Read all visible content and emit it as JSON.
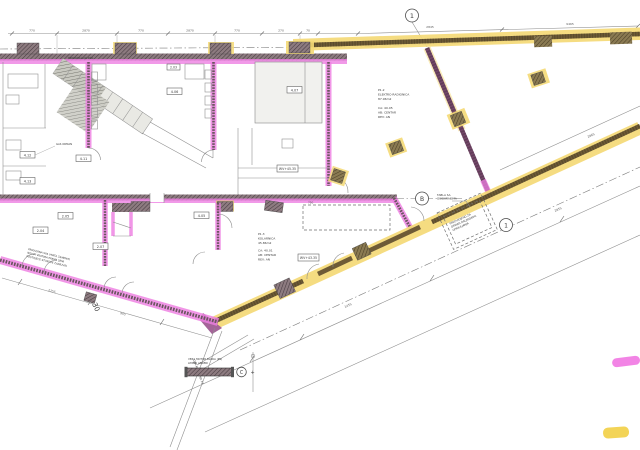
{
  "drawing": {
    "markers": {
      "top_1": "1",
      "mid_b": "B",
      "diag_1": "1",
      "section_c": "C",
      "plus_mark": "+"
    },
    "boxes": {
      "b203": "2.03",
      "b406": "4.06",
      "b407": "4.07",
      "b412": "4.12",
      "b413": "4.13",
      "b411": "4.11",
      "b405": "4.05",
      "b204": "2.04",
      "b205": "2.05",
      "b207": "2.07",
      "wv_upper": "WV+45.35",
      "wv_lower": "WV+43.35"
    },
    "rooms": {
      "p12": {
        "lines": [
          "P1.2",
          "ELEKTRO RADIONICA",
          "87.96m2",
          "CA: 40.05",
          "AB: CENTAR",
          "REV: AN"
        ]
      },
      "p13": {
        "lines": [
          "P1.3",
          "KOLARNICA",
          "45.86m2",
          "CA: 40.01",
          "AB: CENTAR",
          "REV: AN"
        ]
      }
    },
    "notes": {
      "wall_note": [
        "PRIKAZANA SVA VRATA ZAMENITI",
        "NOVIM VRATIMA PREMA SEMI",
        "POSTOJECE STOKOVE ZADRZATI"
      ],
      "tabla_note": [
        "TABLA SA",
        "OSIGURACIMA"
      ],
      "dashed_box_note": [
        "PREDVIDJENO ZA",
        "ORMAN DALJINSKOG",
        "UPRAVLJANJA"
      ],
      "section_note": [
        "VEZA MOTOR BLOKA (PS)",
        "LIMENI ANKERI"
      ],
      "axis_strip": "OSA KOLOSEKA 23",
      "misc_left": "GAS ORMAN",
      "wall_micro": "HIDROIZOLACIJA ZIDA",
      "handnote": "30"
    },
    "dims": {
      "top": [
        "770",
        "2870",
        "770",
        "2870",
        "770",
        "270",
        "70"
      ],
      "top_right": [
        "2845",
        "9465"
      ],
      "diag_below": [
        "2855",
        "1455"
      ],
      "diag_above": "2865",
      "bottom": [
        "2155",
        "905"
      ],
      "rect_label": "750"
    }
  }
}
